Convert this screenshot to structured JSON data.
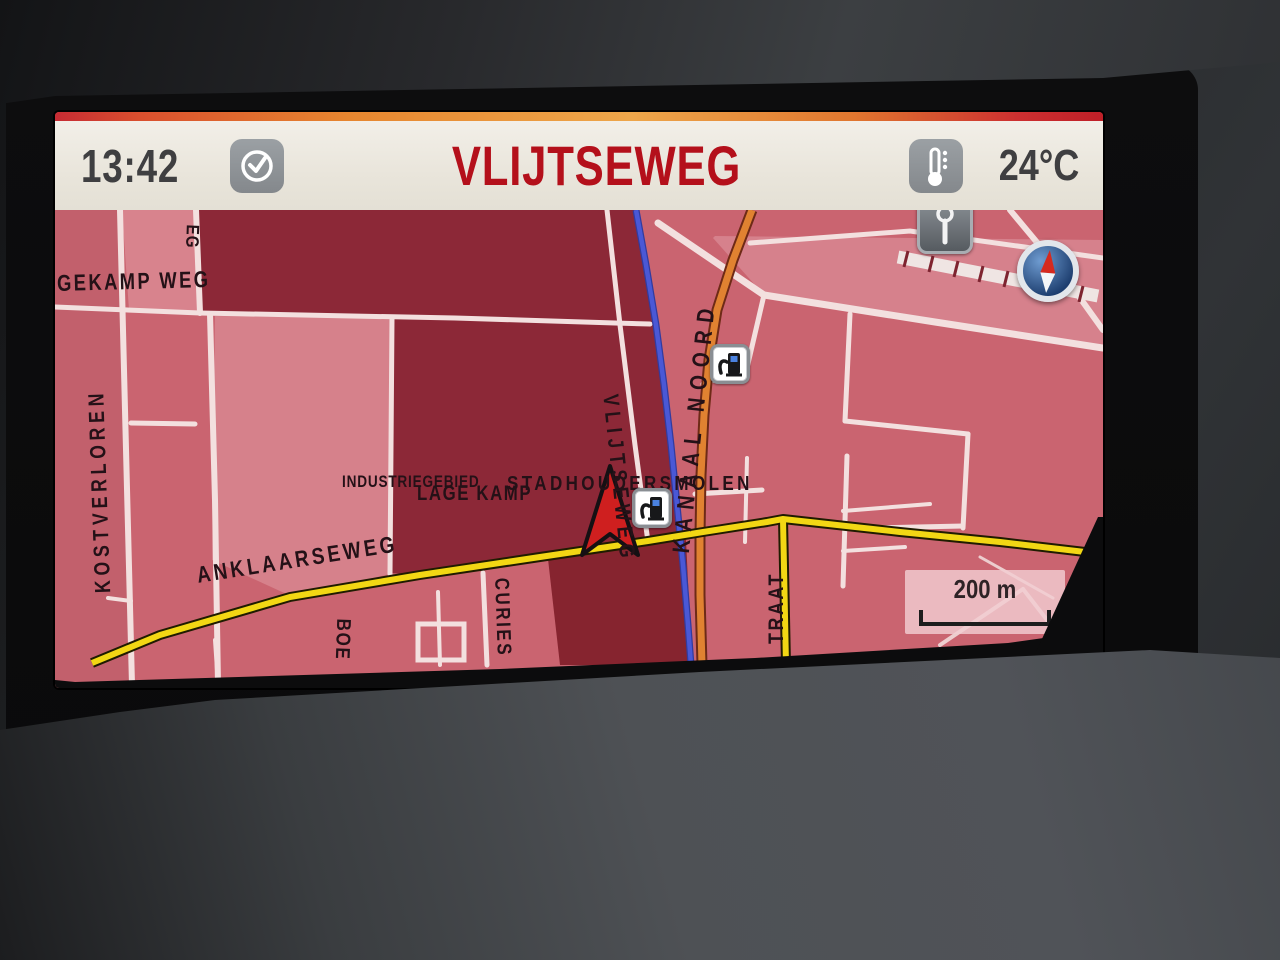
{
  "header": {
    "time": "13:42",
    "title": "VLIJTSEWEG",
    "temperature": "24°C",
    "colors": {
      "title_red": "#B4101B",
      "bar_bg": "#EDE9E0",
      "text_dark": "#3F3F41",
      "icon_gray": "#8F9296",
      "stripe_red": "#C62B33",
      "stripe_orange": "#EDA64A"
    }
  },
  "map": {
    "scale": {
      "label": "200 m"
    },
    "street_labels": {
      "gekampweg": "GEKAMP WEG",
      "weg_partial": "EG",
      "kostverloren": "KOSTVERLOREN",
      "anklaarseweg": "ANKLAARSEWEG",
      "industriegebied": "INDUSTRIEGEBIED",
      "lage_kamp": "LAGE KAMP",
      "stadhoudersmolen": "STADHOUDERSMOLEN",
      "vlijtseweg_street": "VLIJTSEWEG",
      "kanaal_noord": "KANAAL NOORD",
      "curies": "CURIES",
      "straat_partial": "TRAAT",
      "boe_partial": "BOE"
    },
    "icons": {
      "compass": "compass-icon",
      "fuel_station": "fuel-station-icon",
      "poi_marker": "poi-marker-icon",
      "position_arrow": "position-arrow-icon"
    },
    "colors": {
      "map_base": "#CA6470",
      "block_dark": "#8C2837",
      "block_dark2": "#86242F",
      "block_light": "#D6818B",
      "street": "#F3E0DF",
      "route_yellow": "#F2D714",
      "road_orange": "#E08231",
      "canal_blue": "#4A58D6",
      "label_text": "#241117"
    }
  }
}
